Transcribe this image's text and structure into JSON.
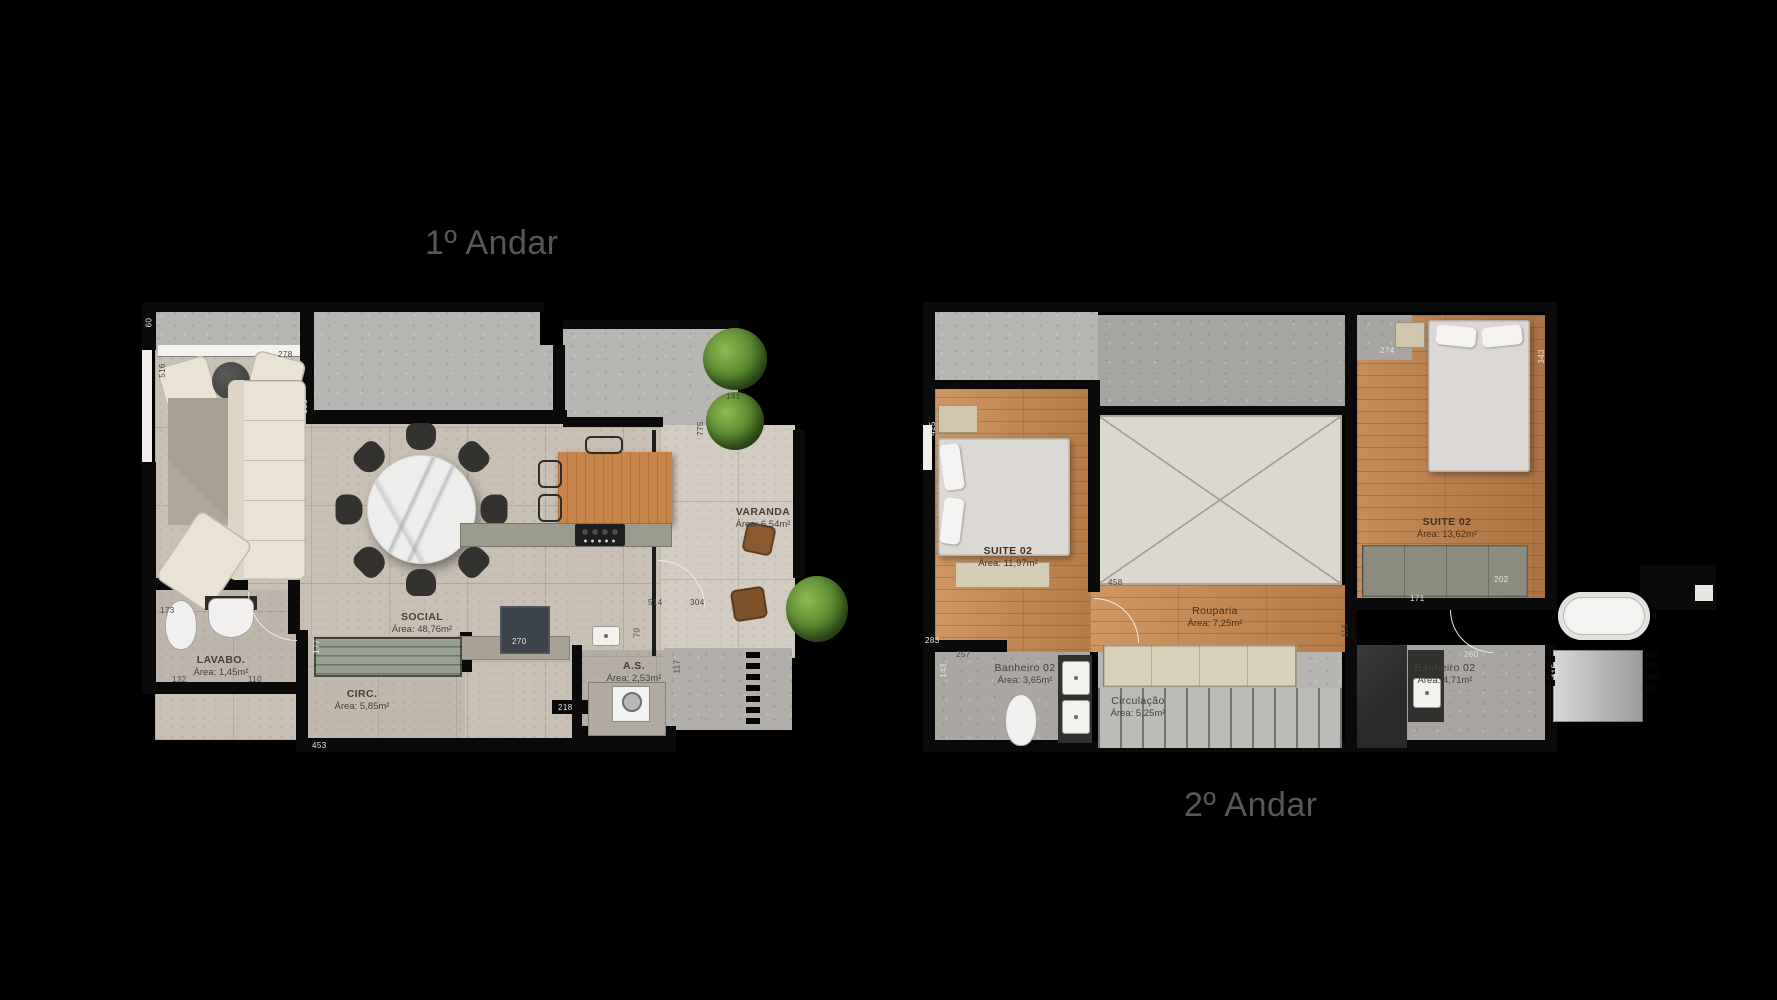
{
  "page": {
    "background": "#000000"
  },
  "floors": {
    "floor1": {
      "title": "1º Andar",
      "rooms": [
        {
          "id": "social",
          "name": "SOCIAL",
          "area": "Área: 48,76m²"
        },
        {
          "id": "lavabo",
          "name": "LAVABO.",
          "area": "Área: 1,45m²"
        },
        {
          "id": "circ",
          "name": "CIRC.",
          "area": "Área: 5,85m²"
        },
        {
          "id": "as",
          "name": "A.S.",
          "area": "Área: 2,53m²"
        },
        {
          "id": "varanda",
          "name": "VARANDA",
          "area": "Área: 6,54m²"
        }
      ],
      "dimensions": [
        "60",
        "516",
        "278",
        "133",
        "173",
        "132",
        "110",
        "453",
        "177",
        "270",
        "218",
        "117",
        "514",
        "304",
        "775",
        "141",
        "70"
      ]
    },
    "floor2": {
      "title": "2º Andar",
      "rooms": [
        {
          "id": "suite-left",
          "name": "SUITE 02",
          "area": "Área: 11,97m²"
        },
        {
          "id": "rouparia",
          "name": "Rouparia",
          "area": "Área: 7,25m²"
        },
        {
          "id": "suite-right",
          "name": "SUITE 02",
          "area": "Área: 13,62m²"
        },
        {
          "id": "banheiro-left",
          "name": "Banheiro 02",
          "area": "Área: 3,65m²"
        },
        {
          "id": "circulacao",
          "name": "Circulação",
          "area": "Área: 5,25m²"
        },
        {
          "id": "banheiro-right",
          "name": "Banheiro 02",
          "area": "Área: 4,71m²"
        }
      ],
      "dimensions": [
        "425",
        "283",
        "143",
        "257",
        "458",
        "116",
        "274",
        "343",
        "202",
        "171",
        "260",
        "115"
      ]
    }
  },
  "colors": {
    "background": "#000000",
    "wall": "#0a0a0a",
    "concrete": "#b7b6b3",
    "floor_tile": "#c8c0b5",
    "wood": "#c98a52",
    "greenery": "#4e7d32",
    "marble": "#ededeb",
    "label_text": "#44403a",
    "title_text": "#575757"
  }
}
